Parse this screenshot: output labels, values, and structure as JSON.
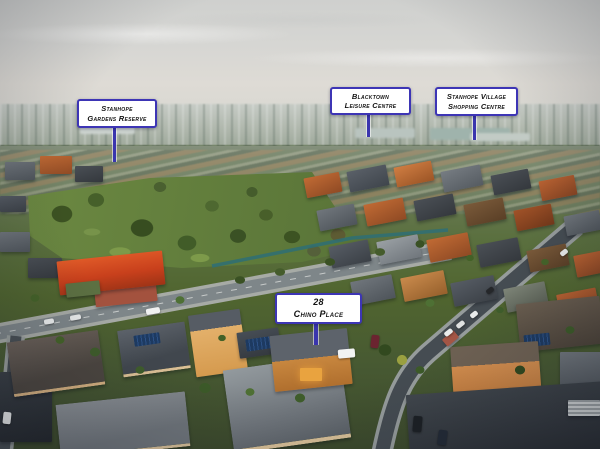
{
  "scene": {
    "type": "aerial-drone-photograph",
    "description": "Dusk aerial photo of a suburban neighbourhood with park, main road and residential streets, annotated with real-estate location callouts"
  },
  "labels": {
    "reserve": {
      "line1": "Stanhope",
      "line2": "Gardens Reserve"
    },
    "leisure": {
      "line1": "Blacktown",
      "line2": "Leisure Centre"
    },
    "shopping": {
      "line1": "Stanhope Village",
      "line2": "Shopping Centre"
    },
    "property": {
      "line1": "28",
      "line2": "Chino Place"
    }
  },
  "colors": {
    "label_border": "#3d35b5",
    "label_background": "#ffffff",
    "label_text": "#111111",
    "pointer_line": "#3a35ae",
    "park_green": "#5b7639",
    "road_asphalt": "#7e8689",
    "terracotta_roof": "#b9622f",
    "slate_roof": "#474c52",
    "sky": "#d6d6d3"
  }
}
